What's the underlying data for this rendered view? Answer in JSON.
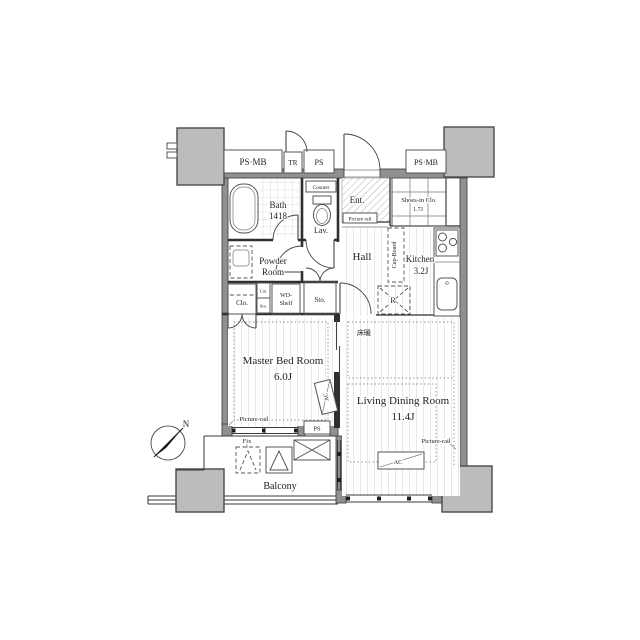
{
  "meta": {
    "drawing_type": "apartment-floor-plan"
  },
  "colors": {
    "background": "#ffffff",
    "wall": "#909090",
    "pillar": "#bcbcbc",
    "line": "#2f2f2f",
    "floor_stripe": "#e8e8e8"
  },
  "labels": {
    "shafts": {
      "psmb_left": "PS·MB",
      "tr": "TR",
      "ps_top": "PS",
      "psmb_right": "PS·MB",
      "ps_lower": "PS"
    },
    "bath": {
      "name": "Bath",
      "size": "1418"
    },
    "lav": {
      "name": "Lav.",
      "counter": "Counter"
    },
    "ent": {
      "name": "Ent.",
      "picture_rail": "Picture rail"
    },
    "shoes": {
      "name": "Shoes-in Clo.",
      "size": "1.7J"
    },
    "kitchen": {
      "name": "Kitchen",
      "size": "3.2J",
      "cupboard": "Cup-Board",
      "fridge": "R"
    },
    "hall": {
      "name": "Hall"
    },
    "powder": {
      "line1": "Powder",
      "line2": "Room"
    },
    "storage": {
      "closet": "Clo.",
      "linen": "Lin.",
      "sto_small": "Sto.",
      "wd1": "WD-",
      "wd2": "Shelf",
      "sto_hall": "Sto."
    },
    "master": {
      "name": "Master Bed Room",
      "size": "6.0J",
      "picture_rail": "Picture-rail",
      "ac": "AC"
    },
    "living": {
      "name": "Living Dining Room",
      "size": "11.4J",
      "picture_rail": "Picture-rail",
      "ac": "AC",
      "floor_heating": "床暖"
    },
    "balcony": {
      "name": "Balcony",
      "fix": "Fix"
    },
    "compass": {
      "north": "N"
    }
  }
}
